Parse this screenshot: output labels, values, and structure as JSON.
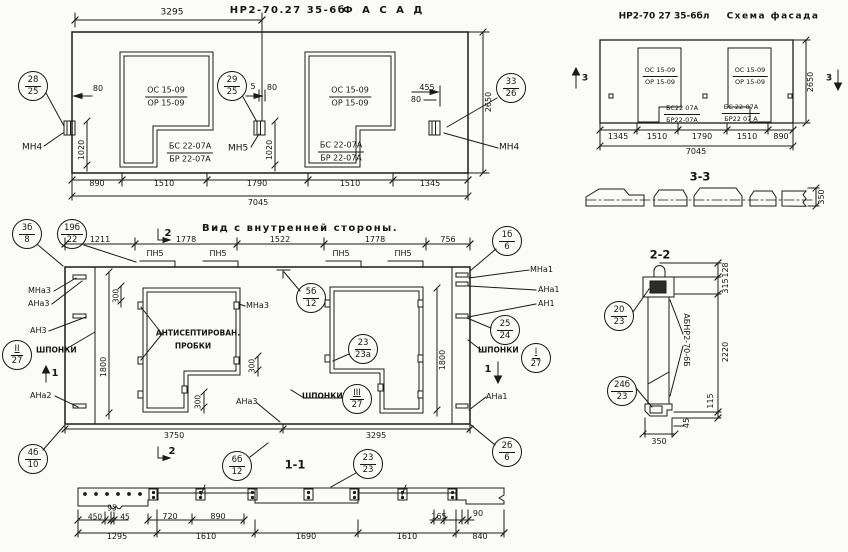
{
  "facade": {
    "code": "НР2-70.27 35-6б",
    "word": "Ф А С А Д",
    "dim_top": "3295",
    "dims_bottom": [
      "890",
      "1510",
      "1790",
      "1510",
      "1345"
    ],
    "dim_total": "7045",
    "dim_height": "2650",
    "d1020l": "1020",
    "d1020m": "1020",
    "d80l": "80",
    "d5": "5",
    "d80m": "80",
    "d80r": "80",
    "d455": "455",
    "mn4l": "МН4",
    "mn5": "МН5",
    "mn4r": "МН4",
    "win1": {
      "sash": "ОС 15-09",
      "frame": "ОР 15-09",
      "block": "БС 22-07А",
      "beam": "БР 22-07А"
    },
    "win2": {
      "sash": "ОС 15-09",
      "frame": "ОР 15-09",
      "block": "БС 22-07А",
      "beam": "БР 22-07А"
    }
  },
  "schema": {
    "code": "НР2-70 27 35-6бл",
    "word": "Схема фасада",
    "dims_bottom": [
      "1345",
      "1510",
      "1790",
      "1510",
      "890"
    ],
    "dim_total": "7045",
    "dim_height": "2650",
    "mark": "3",
    "win1": {
      "sash": "ОС 15-09",
      "frame": "ОР 15-09",
      "block": "БС22 07А",
      "beam": "БР22-07А"
    },
    "win2": {
      "sash": "ОС 15-09",
      "frame": "ОР 15-09",
      "block": "БС 22-07А",
      "beam": "БР22 07 А"
    }
  },
  "sec33": {
    "title": "3-3",
    "d350": "350"
  },
  "sec22": {
    "title": "2-2",
    "vlabel": "АБНР2-70-6Б",
    "d128": "128",
    "d315": "315",
    "d2220": "2220",
    "d115": "115",
    "d45": "45",
    "d350": "350"
  },
  "inner": {
    "title": "Вид с внутренней стороны.",
    "dims_top": [
      "1211",
      "1778",
      "1522",
      "1778",
      "756"
    ],
    "pn5": "ПН5",
    "d1800l": "1800",
    "d1800r": "1800",
    "d300a": "300",
    "d300b": "300",
    "d300c": "300",
    "d3750": "3750",
    "d3295": "3295",
    "note1": "АНТИСЕПТИРОВАН.",
    "note2": "ПРОБКИ",
    "shponki": "ШПОНКИ",
    "mna3l": "МНа3",
    "ana3l": "АНа3",
    "an3l": "АН3",
    "ana2l": "АНа2",
    "mna3w": "МНа3",
    "ana3b": "АНа3",
    "mna1r": "МНа1",
    "ana1r": "АНа1",
    "an1r": "АН1",
    "ana1rb": "АНа1",
    "mark1": "1",
    "mark2": "2"
  },
  "sec11": {
    "title": "1-1",
    "d450": "450",
    "d95": "95",
    "d45": "45",
    "d720": "720",
    "d890": "890",
    "d165": "165",
    "d90": "90",
    "dims_bottom": [
      "1295",
      "1610",
      "1690",
      "1610",
      "840"
    ]
  },
  "callouts": {
    "f28": {
      "top": "28",
      "bottom": "25"
    },
    "f29": {
      "top": "29",
      "bottom": "25"
    },
    "f33": {
      "top": "33",
      "bottom": "26"
    },
    "i3b": {
      "top": "3б",
      "bottom": "8"
    },
    "i19b": {
      "top": "19б",
      "bottom": "22"
    },
    "i4b": {
      "top": "4б",
      "bottom": "10"
    },
    "i1b": {
      "top": "1б",
      "bottom": "6"
    },
    "i2b": {
      "top": "2б",
      "bottom": "6"
    },
    "i5b": {
      "top": "5б",
      "bottom": "12"
    },
    "i25": {
      "top": "25",
      "bottom": "24"
    },
    "i23a": {
      "top": "23",
      "bottom": "23а"
    },
    "ri": {
      "top": "I",
      "bottom": "27"
    },
    "rii": {
      "top": "II",
      "bottom": "27"
    },
    "riii": {
      "top": "III",
      "bottom": "27"
    },
    "b6b": {
      "top": "6б",
      "bottom": "12"
    },
    "b23": {
      "top": "23",
      "bottom": "23"
    },
    "s20": {
      "top": "20",
      "bottom": "23"
    },
    "s24": {
      "top": "24б",
      "bottom": "23"
    }
  },
  "colors": {
    "ink": "#1b1b1b",
    "paper": "#fbfbf8"
  }
}
